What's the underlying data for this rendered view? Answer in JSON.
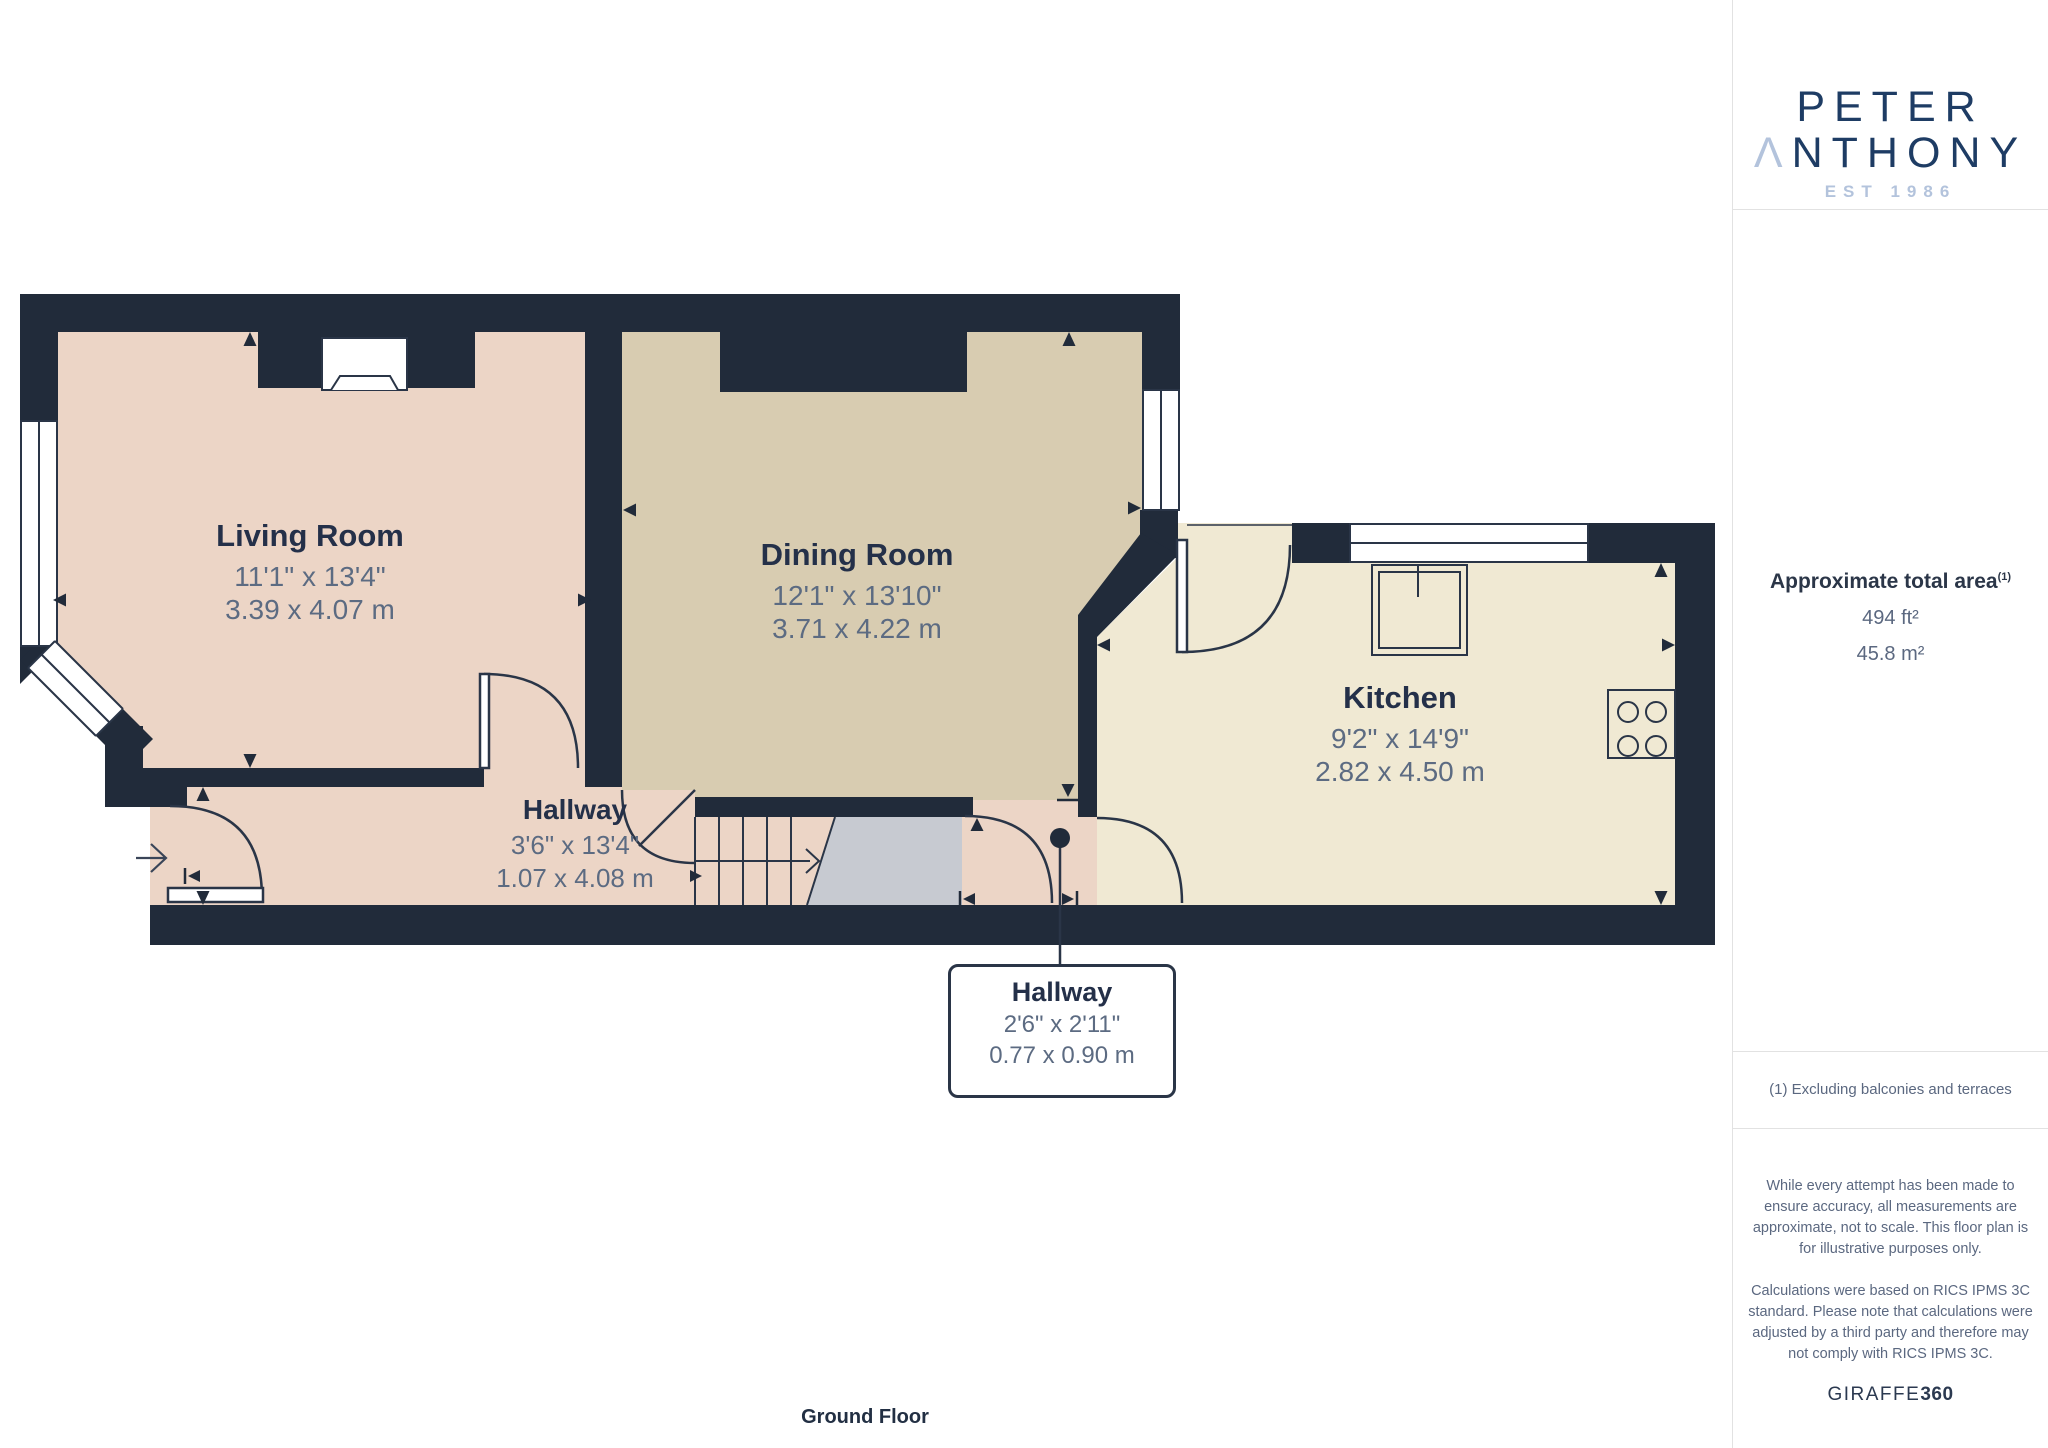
{
  "sidebar": {
    "logo": {
      "line1": "PETER",
      "line2_initial": "Λ",
      "line2_rest": "NTHONY",
      "est": "EST 1986",
      "navy": "#1e3c64",
      "light_blue": "#b3c3dc"
    },
    "area": {
      "heading": "Approximate total area",
      "footnote_marker": "(1)",
      "imperial": "494 ft²",
      "metric": "45.8 m²"
    },
    "footnote": "(1) Excluding balconies and terraces",
    "disclaimer_p1": "While every attempt has been made to ensure accuracy, all measurements are approximate, not to scale. This floor plan is for illustrative purposes only.",
    "disclaimer_p2": "Calculations were based on RICS IPMS 3C standard. Please note that calculations were adjusted by a third party and therefore may not comply with RICS IPMS 3C.",
    "brand_name": "GIRAFFE",
    "brand_number": "360"
  },
  "plan": {
    "floor_label": "Ground Floor",
    "wall_color": "#212b3a",
    "rooms": [
      {
        "name": "Living Room",
        "imperial": "11'1\" x 13'4\"",
        "metric": "3.39 x 4.07 m",
        "floor_color": "#ecd5c6"
      },
      {
        "name": "Dining Room",
        "imperial": "12'1\" x 13'10\"",
        "metric": "3.71 x 4.22 m",
        "floor_color": "#d8ccb1"
      },
      {
        "name": "Kitchen",
        "imperial": "9'2\" x 14'9\"",
        "metric": "2.82 x 4.50 m",
        "floor_color": "#f0e9d3"
      },
      {
        "name": "Hallway",
        "imperial": "3'6\" x 13'4\"",
        "metric": "1.07 x 4.08 m",
        "floor_color": "#ecd5c6"
      },
      {
        "name": "Hallway",
        "imperial": "2'6\" x 2'11\"",
        "metric": "0.77 x 0.90 m",
        "floor_color": "#ecd5c6"
      }
    ]
  }
}
